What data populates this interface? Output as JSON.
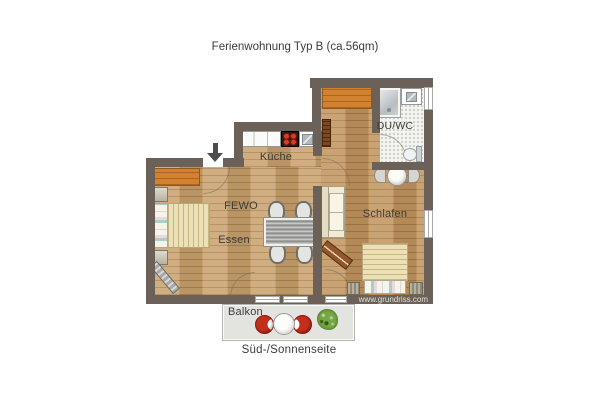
{
  "title": "Ferienwohnung Typ B (ca.56qm)",
  "labels": {
    "kueche": "Küche",
    "fewo": "FEWO",
    "essen": "Essen",
    "schlafen": "Schlafen",
    "duwc": "DU/WC",
    "balkon": "Balkon",
    "orientation": "Süd-/Sonnenseite"
  },
  "watermark": "www.grundriss.com",
  "colors": {
    "wall": "#6b6159",
    "floor_living": "#c9a26e",
    "floor_sleeping": "#c1955e",
    "bath_floor": "#f3f3ef",
    "furniture_orange": "#d2812f",
    "balcony_chair_red": "#c22f1d",
    "plant_green": "#74a844",
    "stove_burner_red": "#d63d22",
    "bed_blanket": "#ece0b6"
  },
  "furniture_icons": [
    "entrance-arrow-icon",
    "kitchen-counter-icon",
    "stove-icon",
    "kitchen-sink-icon",
    "sideboard-icon",
    "double-bed-icon",
    "nightstand-icon",
    "tv-icon",
    "dining-table-icon",
    "dining-chair-icon",
    "wardrobe-icon",
    "tall-cabinet-icon",
    "sofa-icon",
    "coffee-table-icon",
    "shower-icon",
    "washbasin-icon",
    "toilet-icon",
    "round-table-icon",
    "balcony-chair-icon",
    "balcony-table-icon",
    "plant-icon"
  ]
}
